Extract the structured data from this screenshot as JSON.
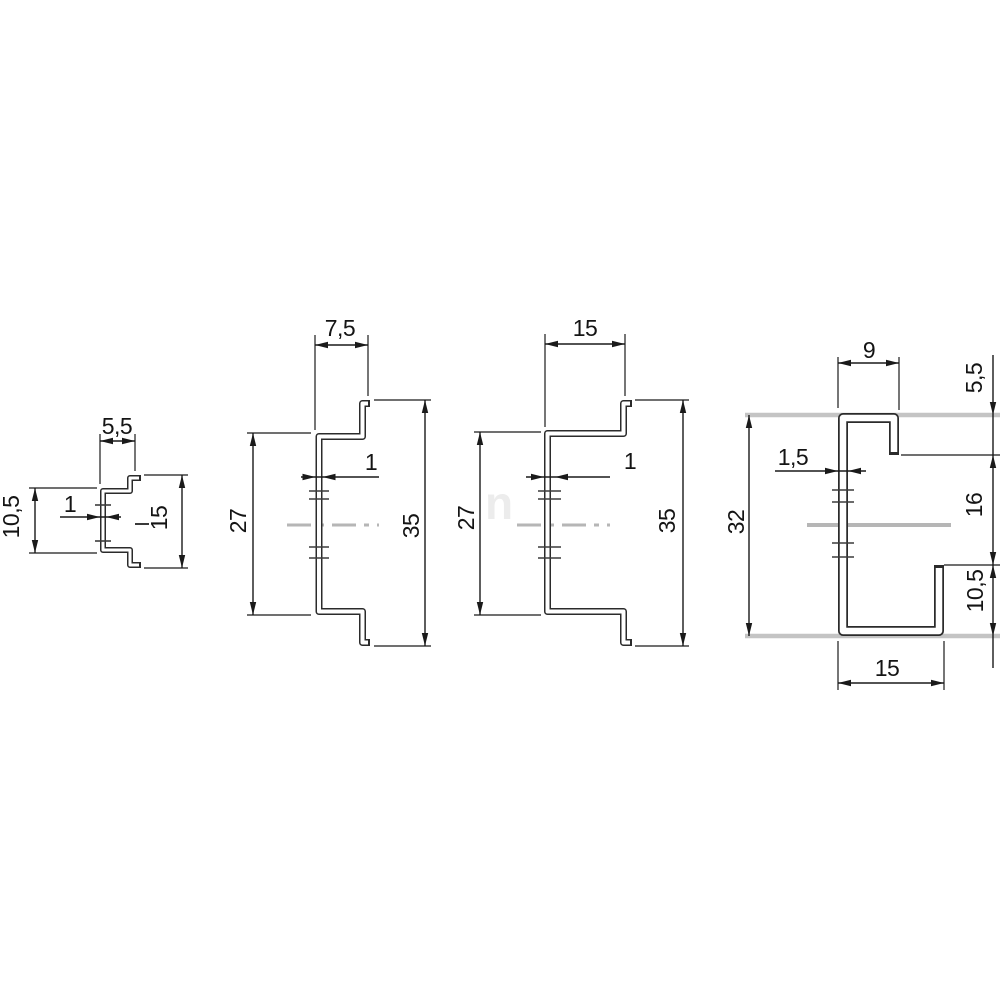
{
  "colors": {
    "background": "#ffffff",
    "outline": "#2b2b2b",
    "dimension_lines": "#1a1a1a",
    "centerline_gray": "#b6b6b6",
    "extension_gray": "#c4c4c4",
    "watermark": "#ececec"
  },
  "diagram": {
    "watermark_text": "n",
    "profile_1": {
      "top_width": "5,5",
      "thickness": "1",
      "left_height": "10,5",
      "right_height": "15"
    },
    "profile_2": {
      "top_width": "7,5",
      "thickness": "1",
      "left_height": "27",
      "right_height": "35"
    },
    "profile_3": {
      "top_width": "15",
      "thickness": "1",
      "left_height": "27",
      "right_height": "35"
    },
    "profile_4": {
      "top_width": "9",
      "top_right_height": "5,5",
      "thickness": "1,5",
      "left_height": "32",
      "right_middle_height": "16",
      "right_bottom_height": "10,5",
      "bottom_width": "15"
    }
  }
}
